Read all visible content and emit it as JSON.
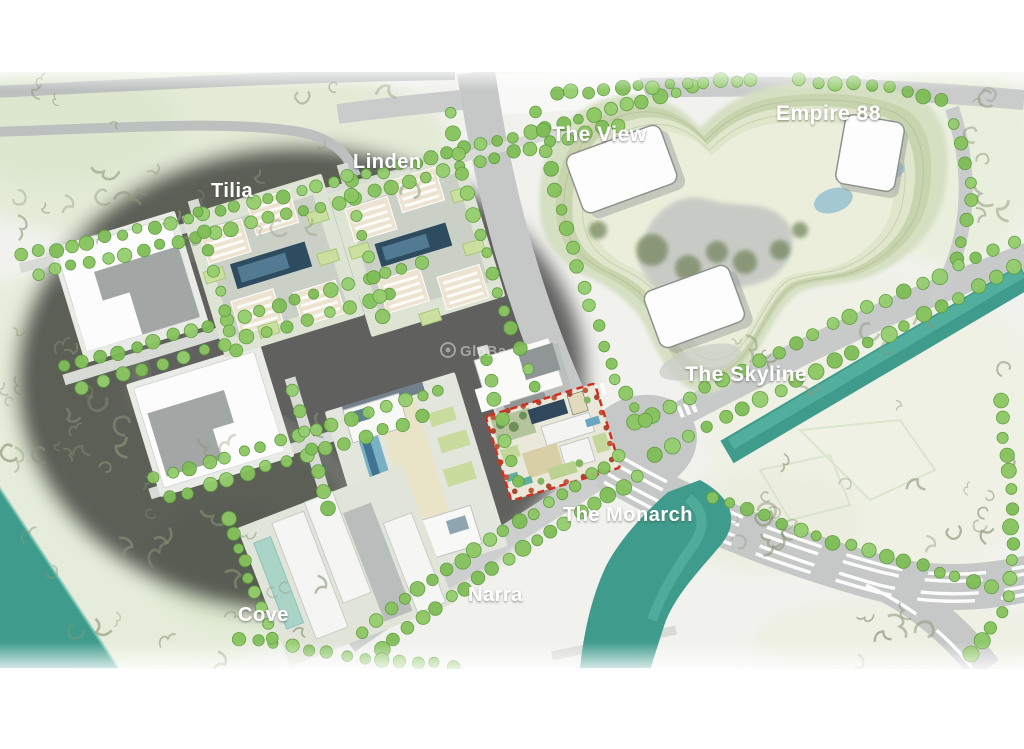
{
  "map": {
    "type": "masterplan-aerial-rendering",
    "highlighted_plot": "The Monarch"
  },
  "labels": {
    "the_view": "The View",
    "empire_88": "Empire 88",
    "linden": "Linden",
    "tilia": "Tilia",
    "the_skyline": "The Skyline",
    "the_monarch": "The Monarch",
    "narra": "Narra",
    "cove": "Cove"
  },
  "watermark": "GloBa",
  "colors": {
    "accent_red": "#d22f21",
    "water": "#3f9c8c",
    "water_light": "#5ab5a3",
    "tree_green": "#8cc763",
    "road_gray": "#c5c8c7",
    "street_gray": "#d8dad6",
    "label_white": "#ffffff",
    "landform": "#d5dfc2",
    "pool_blue": "#6aa6bf"
  }
}
